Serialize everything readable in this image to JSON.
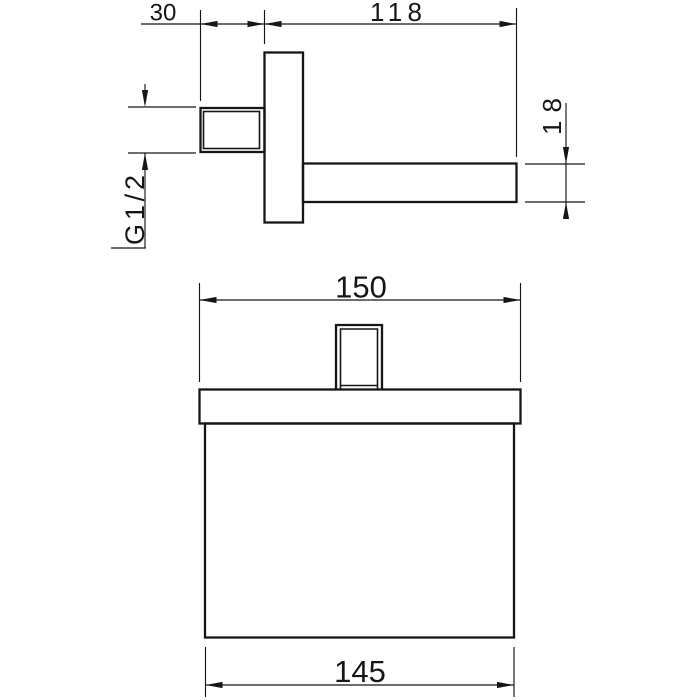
{
  "background_color": "#ffffff",
  "line_color": "#161616",
  "drawing": {
    "side_view": {
      "dim_thread_length": "30",
      "dim_arm_length": "118",
      "dim_arm_height": "18",
      "thread_label": "G1/2"
    },
    "front_view": {
      "dim_plate_width": "150",
      "dim_body_width": "145"
    }
  }
}
